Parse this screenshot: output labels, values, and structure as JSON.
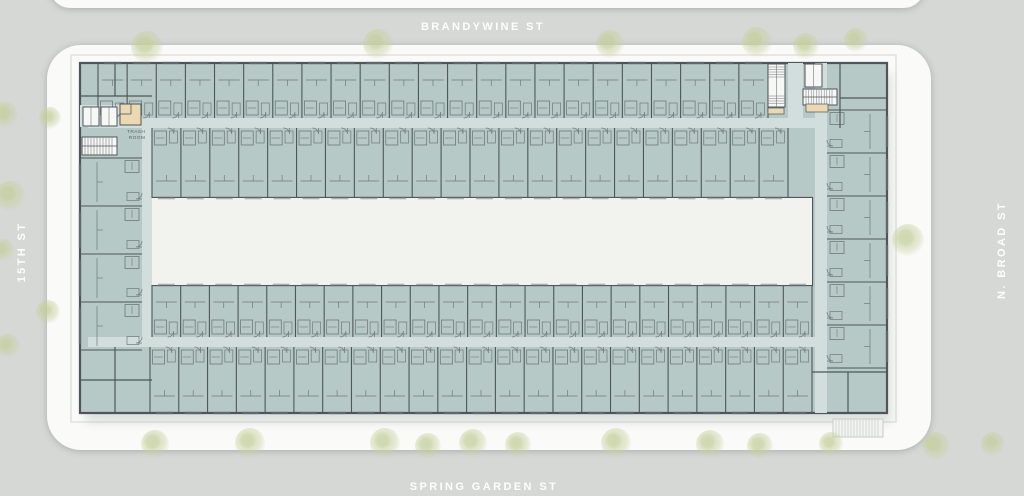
{
  "site": {
    "streets": {
      "north": "BRANDYWINE ST",
      "south": "SPRING GARDEN ST",
      "west": "15TH ST",
      "east": "N. BROAD ST"
    },
    "trees": [
      [
        147,
        47,
        16
      ],
      [
        378,
        44,
        15
      ],
      [
        610,
        44,
        14
      ],
      [
        757,
        42,
        15
      ],
      [
        806,
        46,
        13
      ],
      [
        856,
        40,
        12
      ],
      [
        50,
        118,
        11
      ],
      [
        5,
        115,
        13
      ],
      [
        10,
        196,
        15
      ],
      [
        3,
        250,
        11
      ],
      [
        48,
        312,
        12
      ],
      [
        8,
        346,
        12
      ],
      [
        908,
        240,
        16
      ],
      [
        155,
        444,
        14
      ],
      [
        250,
        443,
        15
      ],
      [
        385,
        443,
        15
      ],
      [
        428,
        446,
        13
      ],
      [
        473,
        443,
        14
      ],
      [
        518,
        445,
        13
      ],
      [
        616,
        443,
        15
      ],
      [
        710,
        444,
        14
      ],
      [
        760,
        446,
        13
      ],
      [
        831,
        444,
        12
      ],
      [
        936,
        446,
        14
      ],
      [
        993,
        444,
        12
      ]
    ]
  },
  "rooms": {
    "trash_line1": "TRASH",
    "trash_line2": "ROOM"
  },
  "colors": {
    "street_bg": "#d6d8d6",
    "pad": "#fafaf8",
    "floor": "#b7c9c6",
    "corridor": "#d2dedb",
    "wall": "#4e565b",
    "wall_mid": "#70797d",
    "tan": "#ead9b2",
    "white_room": "#f7f7f5",
    "courtyard": "#f2f2ef",
    "sidewalk_line": "#e0e2dd",
    "ramp_fill": "#f3f4f1",
    "ramp_line": "#c9ccc7"
  },
  "plan": {
    "wings": {
      "north_street_row": {
        "units": 23
      },
      "north_courtyard_row": {
        "units": 22
      },
      "south_courtyard_row": {
        "units": 23
      },
      "south_street_row": {
        "units": 23
      },
      "east_row": {
        "units": 6
      },
      "west_row": {
        "units": 4
      }
    }
  }
}
